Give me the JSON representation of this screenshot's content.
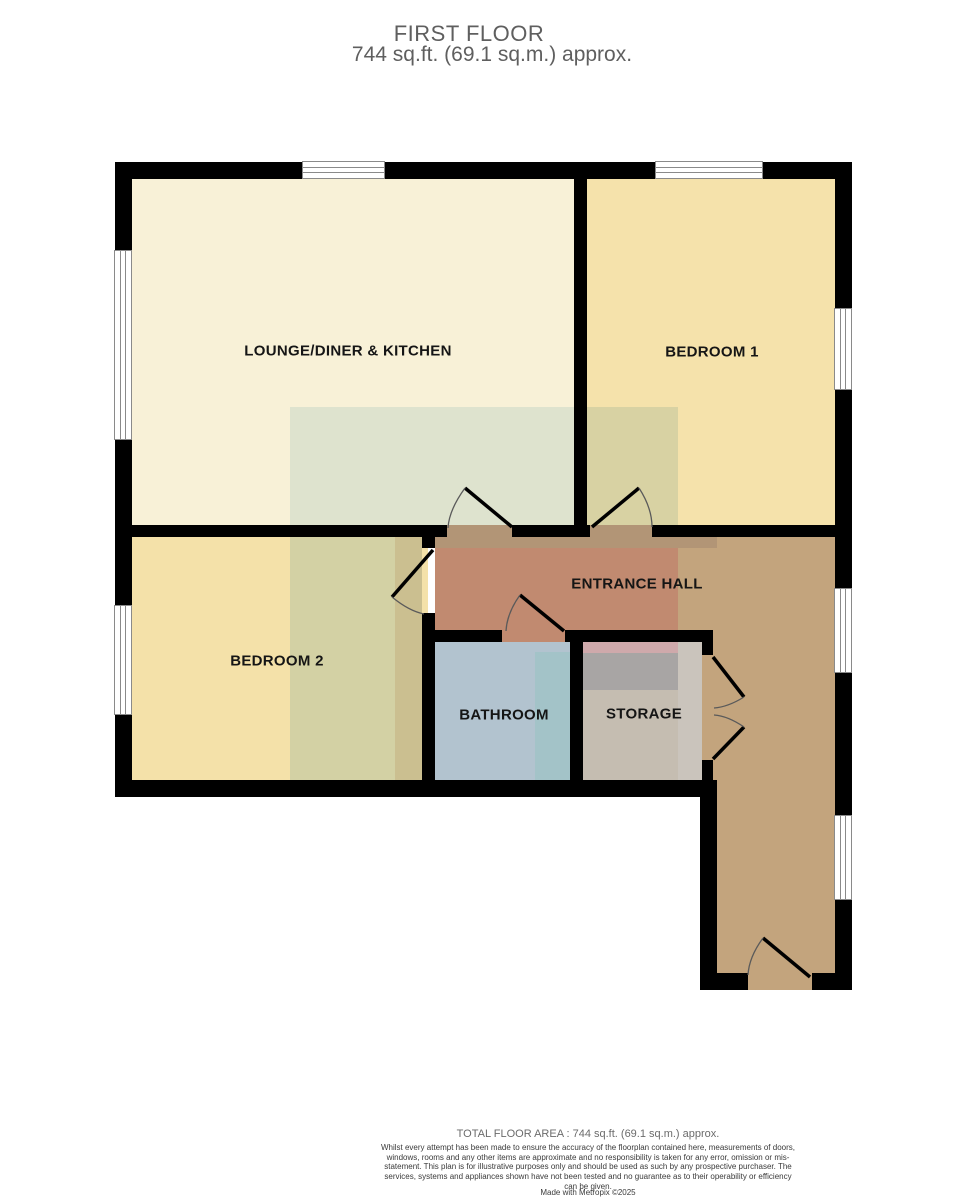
{
  "title": {
    "floor": "FIRST FLOOR",
    "area": "744 sq.ft. (69.1 sq.m.) approx."
  },
  "rooms": {
    "lounge": {
      "label": "LOUNGE/DINER & KITCHEN",
      "fill": "#f8f1d7"
    },
    "bedroom1": {
      "label": "BEDROOM 1",
      "fill": "#f5e2ab"
    },
    "bedroom2": {
      "label": "BEDROOM 2",
      "fill": "#f4e1a9"
    },
    "hall": {
      "label": "ENTRANCE HALL",
      "fill": "#c18a70"
    },
    "bathroom": {
      "label": "BATHROOM",
      "fill": "#b2c3cf"
    },
    "storage": {
      "label": "STORAGE",
      "fill": "#c5bdb1"
    },
    "stair_hall": {
      "fill": "#c3a47d"
    }
  },
  "overlays": {
    "hall_shadow_band": "#b29576",
    "sage_lounge": "#dee3ce",
    "olive_bedroom1": "#d8d2a3",
    "olive_bedroom2": "#d3d1a4",
    "olive_bedroom2_dark": "#cbbf90",
    "bathroom_teal": "#a3c3c8",
    "storage_pink": "#cfa9ab",
    "storage_gray": "#a8a5a4",
    "storage_column": "#cac4bc"
  },
  "structure": {
    "wall": "#000000",
    "window_fill": "#ffffff",
    "window_frame": "#8a8a8a",
    "door_leaf": "#000000",
    "door_arc": "#5a5a5a"
  },
  "footer": {
    "total": "TOTAL FLOOR AREA : 744 sq.ft. (69.1 sq.m.) approx.",
    "disclaimer": "Whilst every attempt has been made to ensure the accuracy of the floorplan contained here, measurements of doors, windows, rooms and any other items are approximate and no responsibility is taken for any error, omission or mis-statement. This plan is for illustrative purposes only and should be used as such by any prospective purchaser. The services, systems and appliances shown have not been tested and no guarantee as to their operability or efficiency can be given.",
    "credit": "Made with Metropix ©2025"
  }
}
